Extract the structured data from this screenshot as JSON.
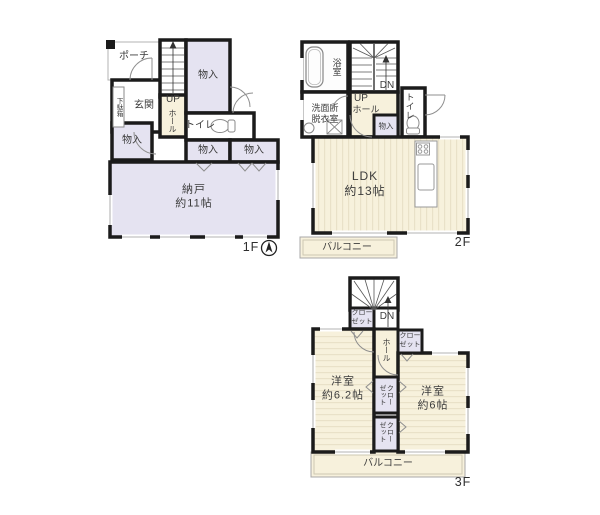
{
  "title": "間取り図",
  "colors": {
    "wall": "#1b1b1b",
    "room_lavender": "#e5e3f1",
    "floor_cream": "#f7f1dc",
    "stripe": "#e9e1c8",
    "white": "#ffffff"
  },
  "floor1": {
    "floor_label": "1F",
    "porch": "ポーチ",
    "entrance": "玄関",
    "shoe_cabinet": "下駄箱",
    "stairs_up": "UP",
    "hall": "ホール",
    "storage_top": "物入",
    "storage_left": "物入",
    "storage_center1": "物入",
    "storage_center2": "物入",
    "toilet": "トイレ",
    "storeroom": "納戸\n約11帖"
  },
  "floor2": {
    "floor_label": "2F",
    "bathroom": "浴室",
    "washroom": "洗面所\n脱衣室",
    "stairs_down": "DN",
    "stairs_up": "UP",
    "hall": "ホール",
    "toilet": "トイレ",
    "storage": "物入",
    "ldk": "LDK\n約13帖",
    "balcony": "バルコニー"
  },
  "floor3": {
    "floor_label": "3F",
    "stairs_down": "DN",
    "hall": "ホール",
    "closet_upper_left": "クロー\nゼット",
    "closet_upper_right": "クロー\nゼット",
    "closet_mid1": "クロー\nゼット",
    "closet_mid2": "クロー\nゼット",
    "room_left": "洋室\n約6.2帖",
    "room_right": "洋室\n約6帖",
    "balcony": "バルコニー"
  }
}
